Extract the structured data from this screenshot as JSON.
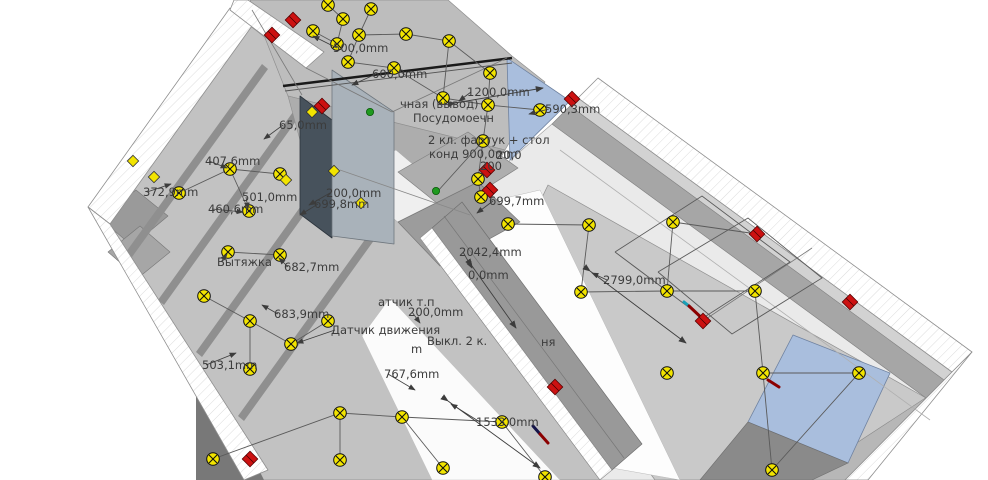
{
  "scene_type": "apartment-electrical-plan-3d",
  "colors": {
    "lamp_yellow": "#f2e400",
    "marker_red": "#cc1111",
    "marker_green": "#1f9a1f",
    "window_blue": "#a9bedd",
    "wall_light": "#d2d2d2",
    "wall_mid": "#b3b3b3",
    "wall_dark": "#8e8e8e",
    "floor_gray": "#c9c9c9",
    "floor_light": "#eaeaea",
    "ceiling": "#bdbdbd",
    "shaft_dark": "#47525c",
    "shaft_light": "#a9b2ba",
    "text": "#3c3c3c",
    "wire": "#5a5a5a",
    "beam": "#1a1a1a"
  },
  "symbols": {
    "lamp": "ceiling-light-symbol",
    "outlet": "wall-outlet-symbol",
    "red": "junction-box-symbol",
    "green": "connection-point-symbol"
  },
  "labels": [
    {
      "text": "500,0mm",
      "x": 333,
      "y": 52,
      "ax": 313,
      "ay": 36
    },
    {
      "text": "600,0mm",
      "x": 372,
      "y": 78,
      "ax": 352,
      "ay": 85
    },
    {
      "text": "1200,0mm",
      "x": 467,
      "y": 96,
      "ax": 459,
      "ay": 101
    },
    {
      "text": "590,3mm",
      "x": 545,
      "y": 113,
      "ax": 529,
      "ay": 114
    },
    {
      "text": "чная (вывод)",
      "x": 400,
      "y": 108
    },
    {
      "text": "Посудомоечн",
      "x": 413,
      "y": 122
    },
    {
      "text": "2 кл. фартук + стол",
      "x": 428,
      "y": 144
    },
    {
      "text": "конд 900,0mm",
      "x": 429,
      "y": 158
    },
    {
      "text": "20,0",
      "x": 496,
      "y": 159
    },
    {
      "text": "200",
      "x": 480,
      "y": 170
    },
    {
      "text": "65,0mm",
      "x": 279,
      "y": 129,
      "ax": 264,
      "ay": 139
    },
    {
      "text": "200,0mm",
      "x": 326,
      "y": 197,
      "ax": 309,
      "ay": 205
    },
    {
      "text": "699,8mm",
      "x": 314,
      "y": 208,
      "ax": 300,
      "ay": 215
    },
    {
      "text": "699,7mm",
      "x": 489,
      "y": 205,
      "ax": 477,
      "ay": 213
    },
    {
      "text": "2042,4mm",
      "x": 459,
      "y": 256,
      "ax": 472,
      "ay": 268
    },
    {
      "text": "0,0mm",
      "x": 468,
      "y": 279
    },
    {
      "text": "407,6mm",
      "x": 205,
      "y": 165,
      "ax": 227,
      "ay": 168
    },
    {
      "text": "372,9mm",
      "x": 143,
      "y": 196,
      "ax": 171,
      "ay": 184
    },
    {
      "text": "501,0mm",
      "x": 242,
      "y": 201,
      "ax": 248,
      "ay": 209
    },
    {
      "text": "460,6mm",
      "x": 208,
      "y": 213,
      "ax": 243,
      "ay": 212
    },
    {
      "text": "Вытяжка",
      "x": 217,
      "y": 266,
      "ax": 227,
      "ay": 254
    },
    {
      "text": "682,7mm",
      "x": 284,
      "y": 271,
      "ax": 279,
      "ay": 258
    },
    {
      "text": "683,9mm",
      "x": 274,
      "y": 318,
      "ax": 262,
      "ay": 305
    },
    {
      "text": "Датчик движения",
      "x": 331,
      "y": 334,
      "ax": 297,
      "ay": 343
    },
    {
      "text": "503,1mm",
      "x": 202,
      "y": 369,
      "ax": 236,
      "ay": 353
    },
    {
      "text": "767,6mm",
      "x": 384,
      "y": 378,
      "ax": 415,
      "ay": 390
    },
    {
      "text": "атчик т.п",
      "x": 378,
      "y": 306
    },
    {
      "text": "200,0mm",
      "x": 408,
      "y": 316,
      "ax": 420,
      "ay": 323
    },
    {
      "text": "Выкл. 2 к.",
      "x": 427,
      "y": 345
    },
    {
      "text": "m",
      "x": 411,
      "y": 353
    },
    {
      "text": "ня",
      "x": 541,
      "y": 346
    },
    {
      "text": "2799,0mm",
      "x": 603,
      "y": 284,
      "ax": 592,
      "ay": 273
    },
    {
      "text": "1533,0mm",
      "x": 476,
      "y": 426,
      "ax": 451,
      "ay": 404
    }
  ],
  "lamps": [
    [
      328,
      5
    ],
    [
      343,
      19
    ],
    [
      371,
      9
    ],
    [
      313,
      31
    ],
    [
      337,
      44
    ],
    [
      359,
      35
    ],
    [
      406,
      34
    ],
    [
      449,
      41
    ],
    [
      490,
      73
    ],
    [
      443,
      98
    ],
    [
      348,
      62
    ],
    [
      394,
      68
    ],
    [
      488,
      105
    ],
    [
      540,
      110
    ],
    [
      483,
      141
    ],
    [
      478,
      179
    ],
    [
      481,
      197
    ],
    [
      179,
      193
    ],
    [
      230,
      169
    ],
    [
      249,
      211
    ],
    [
      280,
      174
    ],
    [
      228,
      252
    ],
    [
      280,
      255
    ],
    [
      204,
      296
    ],
    [
      250,
      321
    ],
    [
      291,
      344
    ],
    [
      328,
      321
    ],
    [
      250,
      369
    ],
    [
      213,
      459
    ],
    [
      340,
      413
    ],
    [
      402,
      417
    ],
    [
      340,
      460
    ],
    [
      443,
      468
    ],
    [
      502,
      422
    ],
    [
      545,
      477
    ],
    [
      581,
      292
    ],
    [
      667,
      291
    ],
    [
      755,
      291
    ],
    [
      667,
      373
    ],
    [
      763,
      373
    ],
    [
      859,
      373
    ],
    [
      772,
      470
    ],
    [
      673,
      222
    ],
    [
      508,
      224
    ],
    [
      589,
      225
    ]
  ],
  "outlets": [
    [
      312,
      112
    ],
    [
      286,
      180
    ],
    [
      334,
      171
    ],
    [
      361,
      203
    ],
    [
      133,
      161
    ],
    [
      154,
      177
    ]
  ],
  "red_markers": [
    [
      272,
      35
    ],
    [
      293,
      20
    ],
    [
      322,
      106
    ],
    [
      487,
      170
    ],
    [
      490,
      190
    ],
    [
      572,
      99
    ],
    [
      757,
      234
    ],
    [
      850,
      302
    ],
    [
      703,
      321
    ],
    [
      555,
      387
    ],
    [
      250,
      459
    ]
  ],
  "green_markers": [
    [
      370,
      112
    ],
    [
      436,
      191
    ]
  ],
  "wires": [
    [
      [
        328,
        5
      ],
      [
        343,
        19
      ],
      [
        337,
        44
      ],
      [
        313,
        31
      ]
    ],
    [
      [
        371,
        9
      ],
      [
        359,
        35
      ],
      [
        406,
        34
      ],
      [
        449,
        41
      ],
      [
        490,
        73
      ]
    ],
    [
      [
        359,
        35
      ],
      [
        348,
        62
      ],
      [
        394,
        68
      ],
      [
        443,
        98
      ]
    ],
    [
      [
        449,
        41
      ],
      [
        443,
        98
      ],
      [
        488,
        105
      ]
    ],
    [
      [
        490,
        73
      ],
      [
        488,
        105
      ],
      [
        540,
        110
      ]
    ],
    [
      [
        488,
        105
      ],
      [
        483,
        141
      ],
      [
        478,
        179
      ],
      [
        481,
        197
      ]
    ],
    [
      [
        483,
        141
      ],
      [
        437,
        192
      ]
    ],
    [
      [
        179,
        193
      ],
      [
        230,
        169
      ],
      [
        280,
        174
      ]
    ],
    [
      [
        230,
        169
      ],
      [
        249,
        211
      ]
    ],
    [
      [
        228,
        252
      ],
      [
        280,
        255
      ]
    ],
    [
      [
        204,
        296
      ],
      [
        250,
        321
      ],
      [
        291,
        344
      ],
      [
        328,
        321
      ]
    ],
    [
      [
        250,
        369
      ],
      [
        250,
        321
      ]
    ],
    [
      [
        213,
        459
      ],
      [
        340,
        413
      ],
      [
        402,
        417
      ]
    ],
    [
      [
        340,
        460
      ],
      [
        340,
        413
      ]
    ],
    [
      [
        402,
        417
      ],
      [
        443,
        468
      ]
    ],
    [
      [
        402,
        417
      ],
      [
        502,
        422
      ]
    ],
    [
      [
        502,
        422
      ],
      [
        545,
        477
      ]
    ],
    [
      [
        581,
        292
      ],
      [
        667,
        291
      ],
      [
        755,
        291
      ]
    ],
    [
      [
        667,
        291
      ],
      [
        673,
        222
      ]
    ],
    [
      [
        673,
        222
      ],
      [
        757,
        234
      ]
    ],
    [
      [
        755,
        291
      ],
      [
        763,
        373
      ],
      [
        859,
        373
      ]
    ],
    [
      [
        763,
        373
      ],
      [
        772,
        470
      ]
    ],
    [
      [
        859,
        373
      ],
      [
        772,
        470
      ]
    ],
    [
      [
        508,
        224
      ],
      [
        589,
        225
      ]
    ],
    [
      [
        589,
        225
      ],
      [
        581,
        292
      ]
    ],
    [
      [
        615,
        252
      ],
      [
        702,
        196
      ],
      [
        790,
        262
      ],
      [
        703,
        318
      ],
      [
        615,
        252
      ]
    ],
    [
      [
        658,
        272
      ],
      [
        748,
        218
      ],
      [
        822,
        278
      ],
      [
        732,
        334
      ],
      [
        658,
        272
      ]
    ]
  ],
  "dim_lines": [
    [
      [
        455,
        103
      ],
      [
        543,
        88
      ]
    ],
    [
      [
        590,
        271
      ],
      [
        686,
        343
      ]
    ],
    [
      [
        448,
        401
      ],
      [
        540,
        468
      ]
    ],
    [
      [
        472,
        266
      ],
      [
        516,
        328
      ]
    ]
  ],
  "accent_segments": [
    {
      "pts": [
        [
          533,
          426
        ],
        [
          540,
          434
        ]
      ],
      "color": "#15154a"
    },
    {
      "pts": [
        [
          540,
          434
        ],
        [
          548,
          443
        ]
      ],
      "color": "#8b0000"
    },
    {
      "pts": [
        [
          684,
          302
        ],
        [
          689,
          306
        ]
      ],
      "color": "#18a0b8"
    },
    {
      "pts": [
        [
          689,
          306
        ],
        [
          706,
          322
        ]
      ],
      "color": "#8b0000"
    },
    {
      "pts": [
        [
          768,
          380
        ],
        [
          779,
          387
        ]
      ],
      "color": "#8b0000"
    }
  ]
}
